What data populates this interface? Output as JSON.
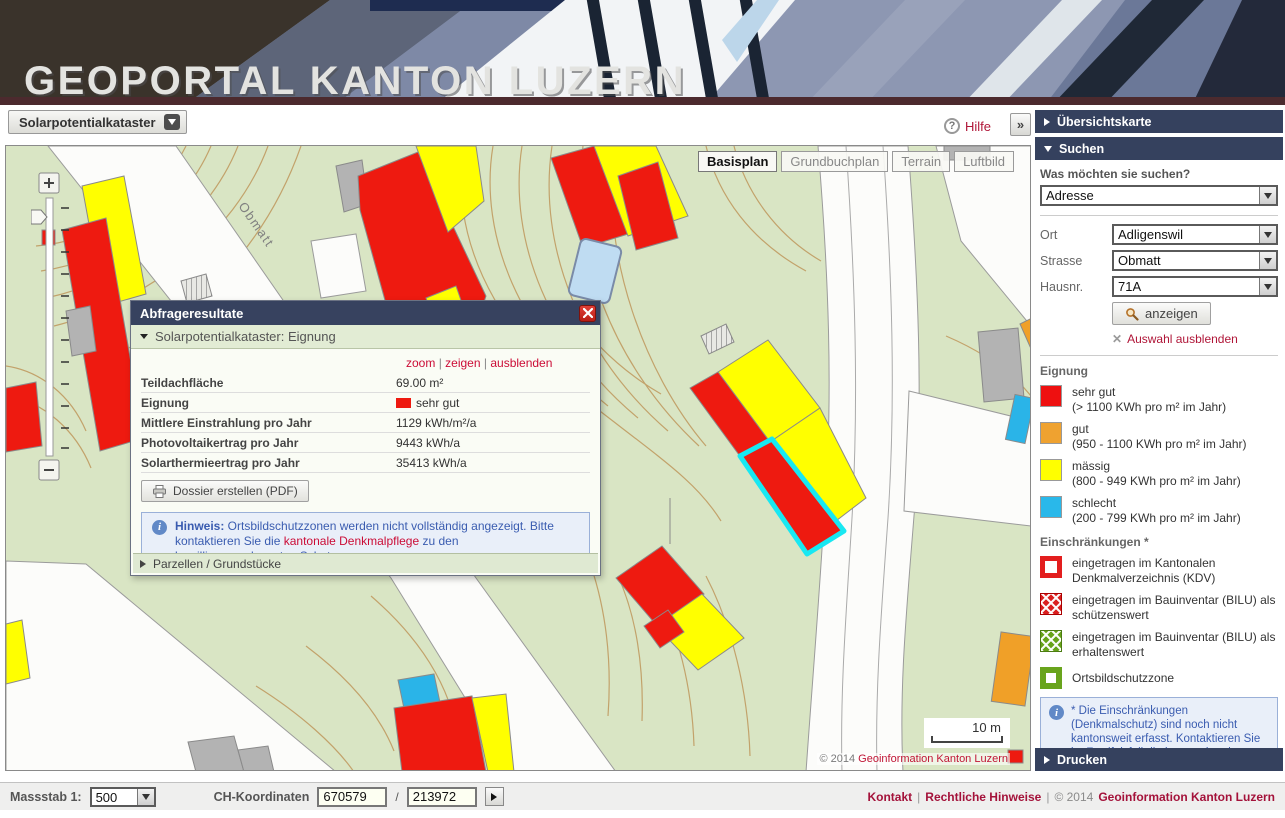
{
  "header": {
    "title": "GEOPORTAL KANTON LUZERN"
  },
  "icons": {
    "help": "?",
    "info": "i",
    "collapse": "»",
    "close": "x"
  },
  "toolbar": {
    "catalog_label": "Solarpotentialkataster",
    "help_label": "Hilfe"
  },
  "map": {
    "layer_buttons": [
      {
        "label": "Basisplan",
        "active": true
      },
      {
        "label": "Grundbuchplan",
        "active": false
      },
      {
        "label": "Terrain",
        "active": false
      },
      {
        "label": "Luftbild",
        "active": false
      }
    ],
    "street_label": "Obmatt",
    "scale_label": "10 m",
    "copyright_prefix": "© 2014",
    "copyright_link": "Geoinformation Kanton Luzern",
    "colors": {
      "sehr_gut": "#ee1a10",
      "gut": "#f0a028",
      "maessig": "#ffff00",
      "schlecht": "#2ab4e8",
      "selection": "#18e8f2"
    }
  },
  "popup": {
    "title": "Abfrageresultate",
    "section": "Solarpotentialkataster: Eignung",
    "links": [
      "zoom",
      "zeigen",
      "ausblenden"
    ],
    "pipe": "|",
    "rows": [
      {
        "label": "Teildachfläche",
        "value": "69.00 m²"
      },
      {
        "label": "Eignung",
        "value": "sehr gut",
        "swatch": "#ee1a10"
      },
      {
        "label": "Mittlere Einstrahlung pro Jahr",
        "value": "1129 kWh/m²/a"
      },
      {
        "label": "Photovoltaikertrag pro Jahr",
        "value": "9443 kWh/a"
      },
      {
        "label": "Solarthermieertrag pro Jahr",
        "value": "35413 kWh/a"
      }
    ],
    "button_label": "Dossier erstellen (PDF)",
    "note_bold": "Hinweis:",
    "note_text1": " Ortsbildschutzzonen werden nicht vollständig angezeigt. Bitte kontaktieren Sie die ",
    "note_link": "kantonale Denkmalpflege",
    "note_text2": " zu den bewilligungsrelevanten Schutzzonen.",
    "bottom_section": "Parzellen / Grundstücke"
  },
  "sidebar": {
    "sections": {
      "overview": "Übersichtskarte",
      "search": "Suchen",
      "print": "Drucken"
    },
    "search": {
      "question": "Was möchten sie suchen?",
      "type_value": "Adresse",
      "fields": [
        {
          "label": "Ort",
          "value": "Adligenswil"
        },
        {
          "label": "Strasse",
          "value": "Obmatt"
        },
        {
          "label": "Hausnr.",
          "value": "71A"
        }
      ],
      "show_button": "anzeigen",
      "hide_link": "Auswahl ausblenden"
    },
    "eignung": {
      "title": "Eignung",
      "items": [
        {
          "label": "sehr gut",
          "range": "(> 1100 KWh pro m² im Jahr)",
          "color": "#ee1010"
        },
        {
          "label": "gut",
          "range": "(950 - 1100 KWh pro m² im Jahr)",
          "color": "#efa230"
        },
        {
          "label": "mässig",
          "range": "(800 - 949 KWh pro m² im Jahr)",
          "color": "#ffff00"
        },
        {
          "label": "schlecht",
          "range": "(200 - 799 KWh pro m² im Jahr)",
          "color": "#29b8ea"
        }
      ]
    },
    "restrictions": {
      "title": "Einschränkungen *",
      "items": [
        {
          "type": "red-outline",
          "label": "eingetragen im Kantonalen Denkmalverzeichnis (KDV)"
        },
        {
          "type": "red-hatch",
          "label": "eingetragen im Bauinventar (BILU) als schützenswert"
        },
        {
          "type": "green-hatch",
          "label": "eingetragen im Bauinventar (BILU) als erhaltenswert"
        },
        {
          "type": "green-outline",
          "label": "Ortsbildschutzzone"
        }
      ]
    },
    "note": "* Die Einschränkungen (Denkmalschutz) sind noch nicht kantonsweit erfasst. Kontaktieren Sie im Zweifelsfall die kantonale oder städtische Denkmalpflege."
  },
  "statusbar": {
    "scale_label": "Massstab 1:",
    "scale_value": "500",
    "coords_label": "CH-Koordinaten",
    "coord_x": "670579",
    "coord_y": "213972",
    "slash": "/",
    "pipe": "|",
    "links": [
      "Kontakt",
      "Rechtliche Hinweise"
    ],
    "copyright_prefix": "© 2014",
    "copyright_link": "Geoinformation Kanton Luzern"
  }
}
